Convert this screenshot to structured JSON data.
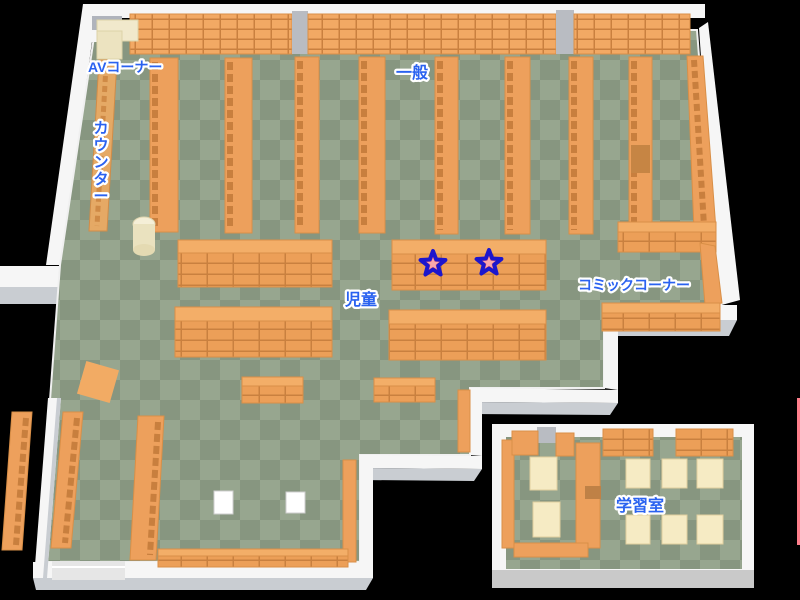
{
  "page": {
    "type": "library-floor-map",
    "background_color": "#000000"
  },
  "palette": {
    "floor_light": "#97a68f",
    "floor_dark": "#879680",
    "wall_white": "#f6f6f6",
    "wall_gray": "#c9cdd2",
    "shelf_orange": "#eda05c",
    "shelf_top_orange": "#f3ae68",
    "shelf_line_brown": "#c9803f",
    "desk_cream": "#f6ebc4",
    "av_cream": "#f1e9cc",
    "label_blue": "#2a62f0",
    "label_outline": "#ffffff",
    "star_fill": "#ee5f6c",
    "star_inner": "#f8a7ab",
    "star_outline": "#1c16cd",
    "edge_marker_pink": "#ff7f8c"
  },
  "areas": {
    "av_corner": {
      "label": "AVコーナー"
    },
    "general": {
      "label": "一般"
    },
    "counter": {
      "label": "カウンター",
      "label_chars": [
        "カ",
        "ウ",
        "ン",
        "タ",
        "ー"
      ]
    },
    "children": {
      "label": "児童"
    },
    "comic_corner": {
      "label": "コミックコーナー"
    },
    "study_room": {
      "label": "学習室"
    }
  },
  "markers": {
    "stars": [
      {
        "id": "star-marker-1",
        "x": 433,
        "y": 264
      },
      {
        "id": "star-marker-2",
        "x": 489,
        "y": 263
      }
    ]
  }
}
